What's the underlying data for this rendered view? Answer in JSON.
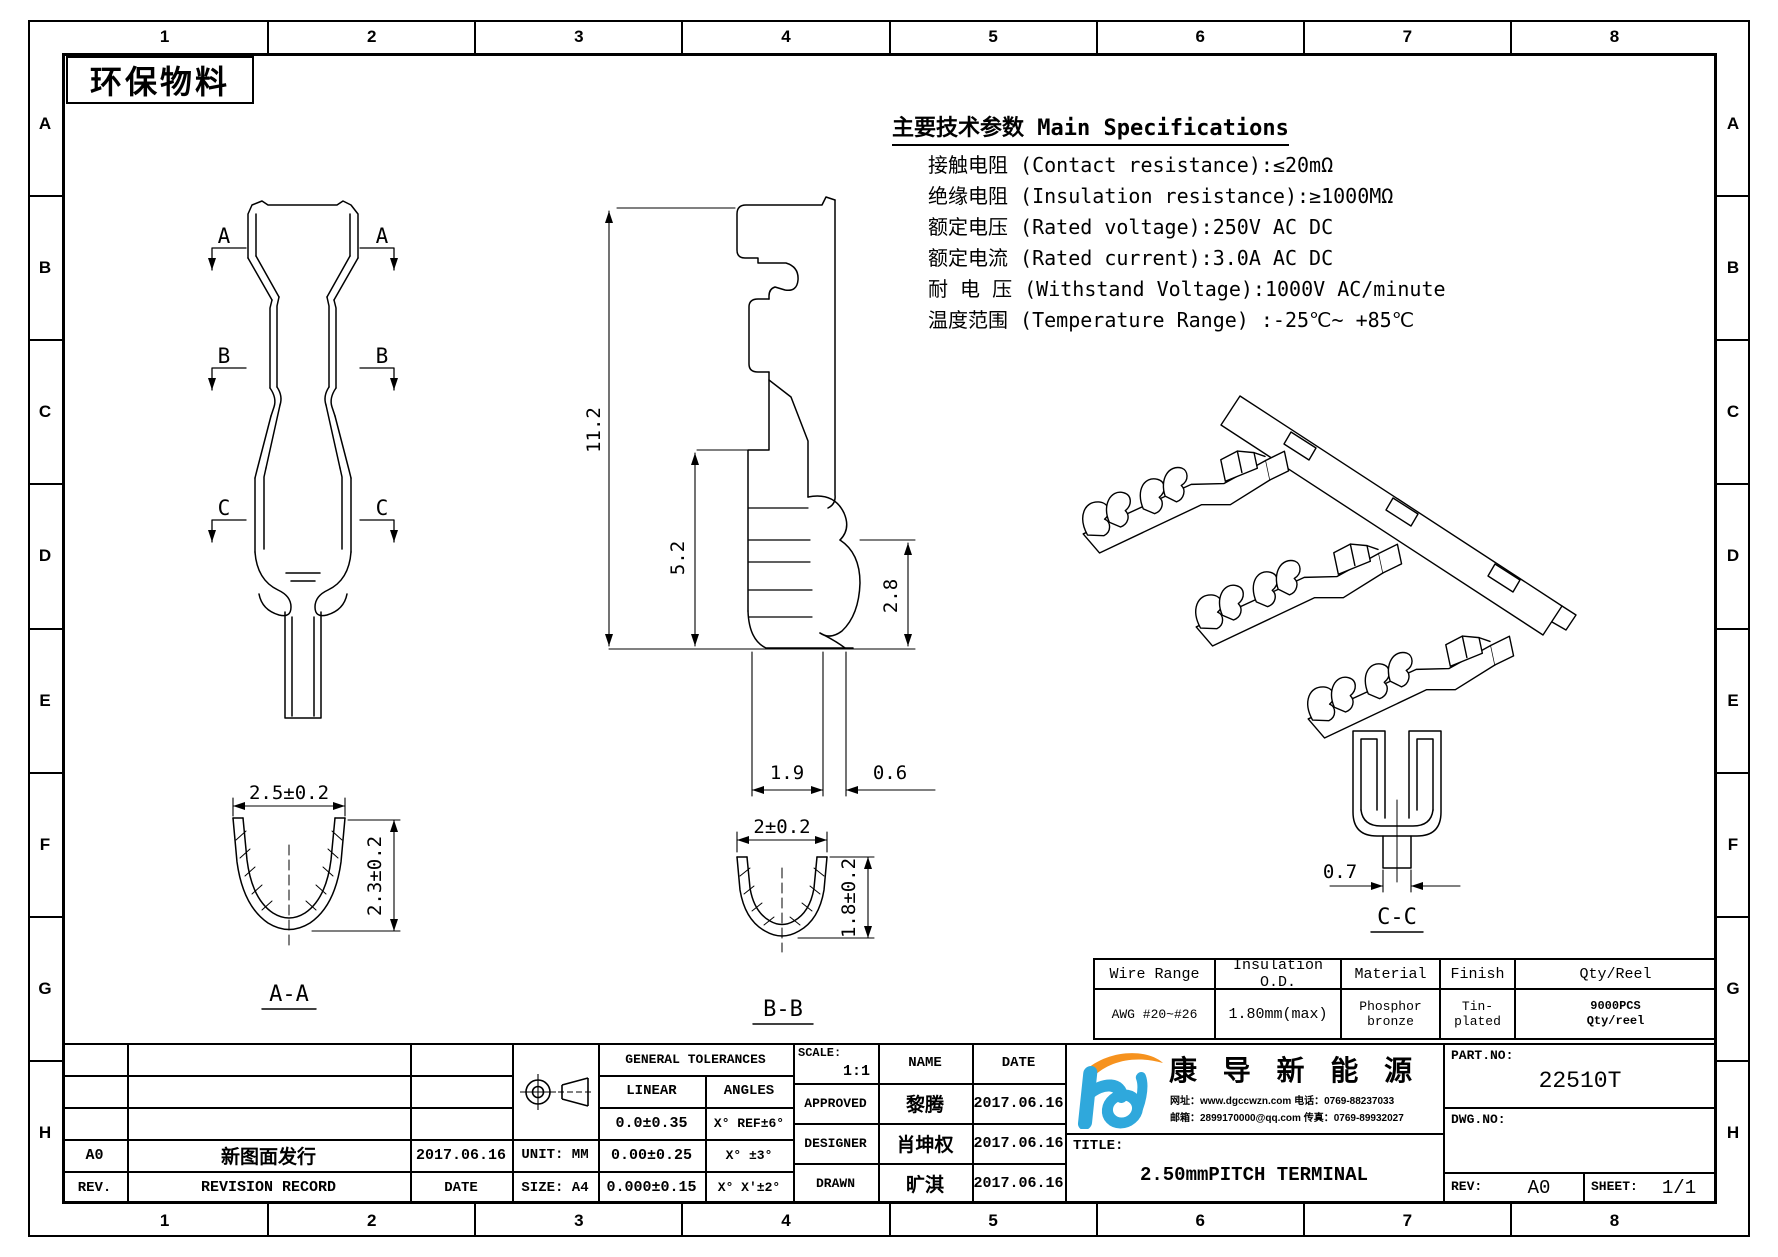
{
  "colors": {
    "line": "#000000",
    "background": "#ffffff",
    "logo_blue": "#2fa8dc",
    "logo_orange": "#f6921e"
  },
  "frame": {
    "zone_columns": [
      "1",
      "2",
      "3",
      "4",
      "5",
      "6",
      "7",
      "8"
    ],
    "zone_rows": [
      "A",
      "B",
      "C",
      "D",
      "E",
      "F",
      "G",
      "H"
    ],
    "eco_label": "环保物料"
  },
  "specs": {
    "title": "主要技术参数 Main Specifications",
    "lines": [
      "接触电阻 (Contact resistance):≤20mΩ",
      "绝缘电阻 (Insulation resistance):≥1000MΩ",
      "额定电压 (Rated voltage):250V AC DC",
      "额定电流 (Rated current):3.0A AC DC",
      "耐 电 压 (Withstand Voltage):1000V AC/minute",
      "温度范围 (Temperature Range) :-25℃~ +85℃"
    ]
  },
  "views": {
    "front": {
      "marker_a": "A",
      "marker_b": "B",
      "marker_c": "C"
    },
    "section_aa": {
      "label": "A-A",
      "width_dim": "2.5±0.2",
      "height_dim": "2.3±0.2"
    },
    "side": {
      "overall_height": "11.2",
      "crimp_height": "5.2",
      "wing_height": "2.8",
      "crimp_width": "1.9",
      "wing_thickness": "0.6"
    },
    "section_bb": {
      "label": "B-B",
      "width_dim": "2±0.2",
      "height_dim": "1.8±0.2"
    },
    "section_cc": {
      "label": "C-C",
      "width_dim": "0.7"
    }
  },
  "wire_table": {
    "headers": [
      "Wire Range",
      "Insulation O.D.",
      "Material",
      "Finish",
      "Qty/Reel"
    ],
    "row": {
      "wire_range": "AWG #20~#26",
      "insulation_od": "1.80mm(max)",
      "material_line1": "Phosphor",
      "material_line2": "bronze",
      "finish_line1": "Tin-",
      "finish_line2": "plated",
      "qty_line1": "9000PCS",
      "qty_line2": "Qty/reel"
    }
  },
  "title_block": {
    "revision_row": {
      "rev": "A0",
      "description": "新图面发行",
      "date": "2017.06.16"
    },
    "header_row": {
      "rev": "REV.",
      "description": "REVISION RECORD",
      "date": "DATE"
    },
    "unit": "UNIT: MM",
    "size": "SIZE: A4",
    "tolerances": {
      "title": "GENERAL TOLERANCES",
      "linear": "LINEAR",
      "angles": "ANGLES",
      "linear_rows": [
        "0.0±0.35",
        "0.00±0.25",
        "0.000±0.15"
      ],
      "angle_rows": [
        "X° REF±6°",
        "X° ±3°",
        "X° X'±2°"
      ]
    },
    "scale_label": "SCALE:",
    "scale_value": "1:1",
    "name_header": "NAME",
    "date_header": "DATE",
    "signoff": [
      {
        "role": "APPROVED",
        "name": "黎腾",
        "date": "2017.06.16"
      },
      {
        "role": "DESIGNER",
        "name": "肖坤权",
        "date": "2017.06.16"
      },
      {
        "role": "DRAWN",
        "name": "旷淇",
        "date": "2017.06.16"
      }
    ],
    "company": {
      "name": "康 导 新 能 源",
      "contact_line1": "网址：www.dgccwzn.com  电话：0769-88237033",
      "contact_line2": "邮箱：2899170000@qq.com 传真：0769-89932027"
    },
    "title_label": "TITLE:",
    "drawing_title": "2.50mmPITCH TERMINAL",
    "part_no_label": "PART.NO:",
    "part_no": "22510T",
    "dwg_no_label": "DWG.NO:",
    "rev_label": "REV:",
    "rev_value": "A0",
    "sheet_label": "SHEET:",
    "sheet_value": "1/1"
  }
}
